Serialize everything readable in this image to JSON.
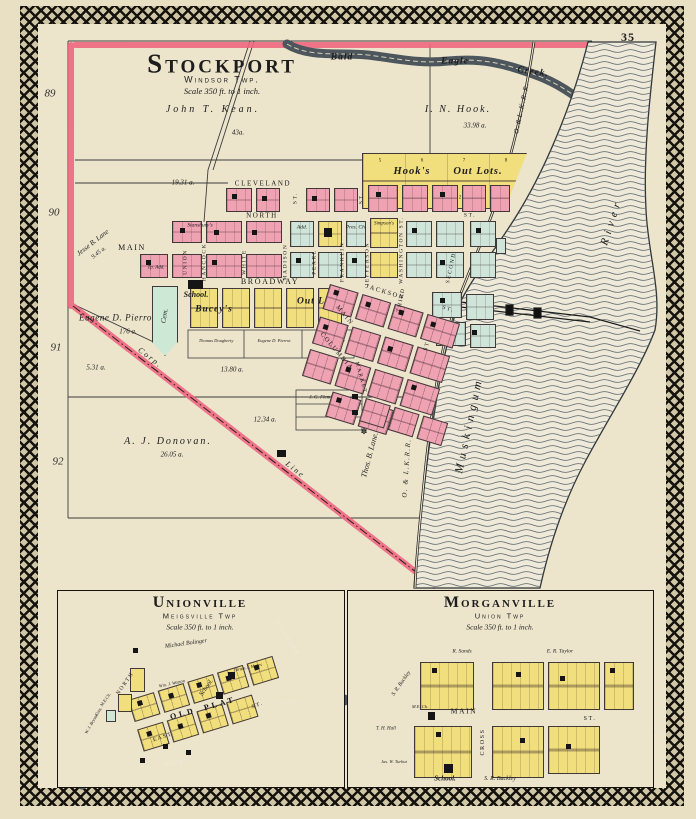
{
  "page": {
    "number": "35"
  },
  "margins": {
    "n89": "89",
    "n90": "90",
    "n91": "91",
    "n92": "92"
  },
  "colors": {
    "paper": "#ece4cb",
    "block_pink": "#efa2b2",
    "block_yellow": "#f1de7d",
    "block_cyan": "#cfe5da",
    "cemetery_green": "#cde9d6",
    "boundary_pink": "#f0647e",
    "water_dark": "#4c565c"
  },
  "sp": {
    "title": "Stockport",
    "twp": "Windsor Twp.",
    "scale": "Scale 350 ft. to 1 inch.",
    "creek": {
      "w1": "Bald",
      "w2": "Eagle",
      "w3": "Creek."
    },
    "river": {
      "w1": "Muskingum",
      "w2": "River"
    },
    "rr": "O.&L.K.R.R.",
    "rr2": "O. & L.K.R.R.",
    "owners": {
      "kean": "John T. Kean.",
      "kean_a": "43a.",
      "hook": "I. N. Hook.",
      "hook_a": "33.98 a.",
      "a1931": "19.31 a.",
      "lane": "Jesse B. Lane",
      "lane_a": "9.45 a.",
      "pierrot": "Eugene D. Pierrot",
      "pierrot_a": "176 a.",
      "a531": "5.31 a.",
      "a1380": "13.80 a.",
      "a1234": "12.34 a.",
      "donovan": "A. J. Donovan.",
      "donovan_a": "26.05 a.",
      "thoslane": "Thos. B. Lane.",
      "fleming": "J. G. Fleming",
      "dougherty": "Thomas Dougherty",
      "pierrot2": "Eugene D. Pierrot",
      "downey": "Emma P. Downey",
      "corp": "Corp.",
      "line": "Line"
    },
    "features": {
      "hooks": "Hook's",
      "outlots": "Out Lots.",
      "buceys": "Bucey's",
      "outlots2": "Out Lots",
      "school": "School.",
      "cem": "Cem.",
      "presch": "Pres. Ch.",
      "add": "Add.",
      "stansburys": "Stansbury's",
      "simpsons": "Simpson's",
      "tpadd": "Tp. Add."
    },
    "lots": [
      "1",
      "2",
      "3",
      "4",
      "5",
      "6",
      "7",
      "8"
    ],
    "streets": {
      "cleveland": "CLEVELAND",
      "north": "NORTH",
      "main": "MAIN",
      "broadway": "BROADWAY",
      "union": "UNION",
      "hancock": "HANCOCK",
      "white": "WHITE",
      "madison": "MADISON",
      "pearl": "PEARL",
      "franklin": "FRANKLIN",
      "jefferson": "JEFFERSON",
      "washington": "WASHINGTON ST.",
      "third": "THIRD",
      "second": "SECOND",
      "jackson": "JACKSON",
      "columbia": "COLUMBIA",
      "market": "MARKET",
      "main2": "MAIN",
      "st": "ST."
    }
  },
  "uv": {
    "title": "Unionville",
    "twp": "Meigsville Twp",
    "scale": "Scale 350 ft. to 1 inch.",
    "bolinger": "Michael Bolinger",
    "watson": "Wm. J. Watson",
    "moses": "Hiram J. Moses",
    "bryson": "W. J. Bryson",
    "school": "School.",
    "mech": "M.E.Ch.",
    "cem": "Cem.",
    "old": "OLD",
    "plat": "PLAT",
    "north": "NORTH",
    "east": "EAST",
    "st": "ST.",
    "dyesfork": "DYES FORK",
    "meigs": "Meigs",
    "creek": "Creek"
  },
  "mv": {
    "title": "Morganville",
    "twp": "Union Twp",
    "scale": "Scale 350 ft. to 1 inch.",
    "sands": "R. Sands",
    "taylor": "E. R. Taylor",
    "buckley": "S. R. Buckley",
    "hall": "T. H. Hall",
    "turbut": "Jas. W. Turbut",
    "school": "School.",
    "mech": "M.E. Ch.",
    "buckley2": "S. R. Buckley",
    "main": "MAIN",
    "st": "ST.",
    "cross": "CROSS"
  }
}
